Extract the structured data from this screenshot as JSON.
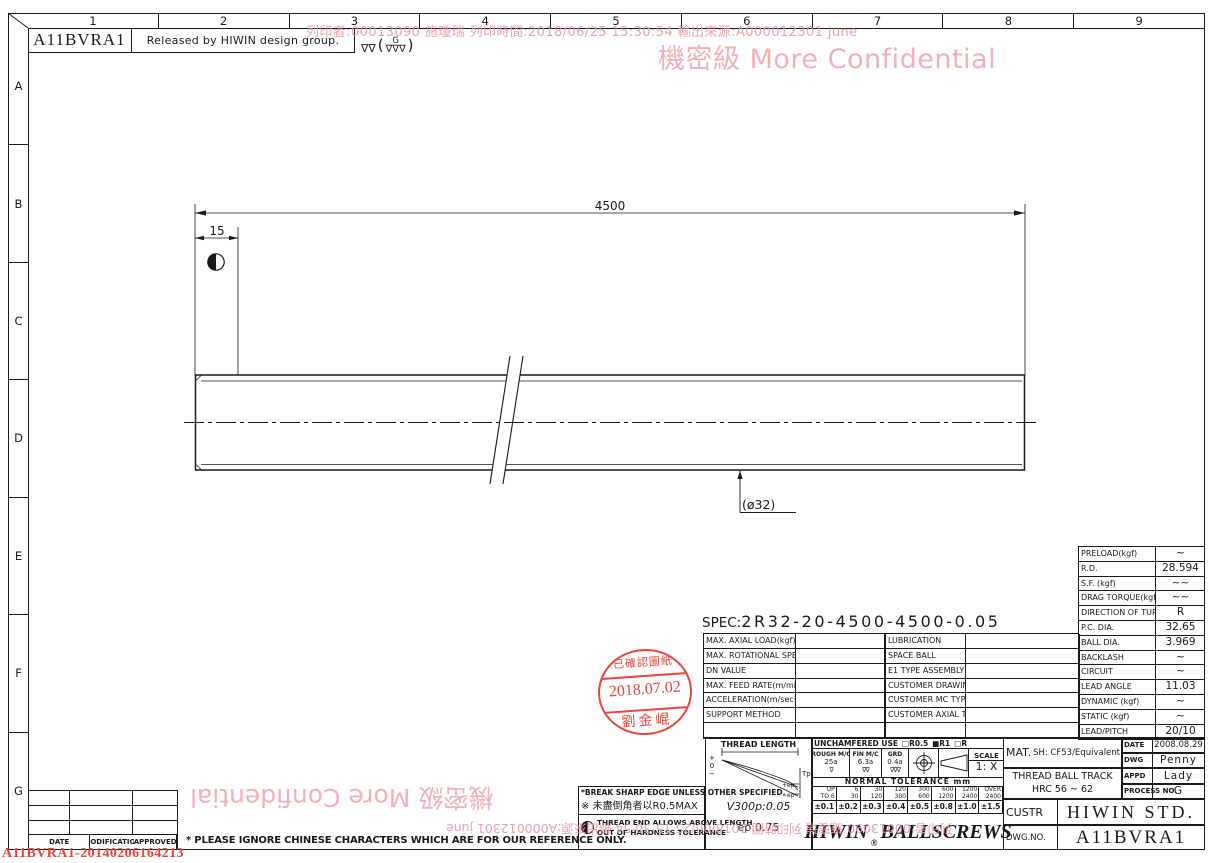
{
  "colors": {
    "line": "#1a1a1a",
    "watermark_pink": "#f3b1b6",
    "watermark_red": "#ec9aa3",
    "stamp_red": "#e5392f",
    "doc_id_red": "#e8443b"
  },
  "border": {
    "cols": [
      "1",
      "2",
      "3",
      "4",
      "5",
      "6",
      "7",
      "8",
      "9"
    ],
    "rows": [
      "A",
      "B",
      "C",
      "D",
      "E",
      "F",
      "G"
    ]
  },
  "header": {
    "code": "A11BVRA1",
    "released": "Released by HIWIN design group.",
    "finish_prefix": "∇∇",
    "finish_open": "(",
    "finish_grade": "G",
    "finish_marks": "∇∇∇",
    "finish_close": ")"
  },
  "watermark": {
    "print_line": "列印者:00013090 施瓊瑞 列印時間:2018/06/25 15:30:54 輸出來源:A000012301 june",
    "confidential": "機密級 More Confidential",
    "doc_id": "A11BVRA1-20140206164213"
  },
  "drawing": {
    "dim_total": "4500",
    "dim_left": "15",
    "diameter": "(ø32)"
  },
  "spec": {
    "label": "SPEC:",
    "value": "2R32-20-4500-4500-0.05"
  },
  "spec_table": {
    "left_rows": [
      {
        "label": "MAX. AXIAL LOAD(kgf)",
        "value": ""
      },
      {
        "label": "MAX. ROTATIONAL SPEED(rpm)",
        "value": ""
      },
      {
        "label": "DN VALUE",
        "value": ""
      },
      {
        "label": "MAX. FEED RATE(m/min)",
        "value": ""
      },
      {
        "label": "ACCELERATION(m/sec²)",
        "value": ""
      },
      {
        "label": "SUPPORT METHOD",
        "value": ""
      },
      {
        "label": "",
        "value": ""
      }
    ],
    "right_rows": [
      {
        "label": "LUBRICATION",
        "value": ""
      },
      {
        "label": "SPACE BALL",
        "value": ""
      },
      {
        "label": "E1 TYPE ASSEMBLY METHOD",
        "value": ""
      },
      {
        "label": "CUSTOMER DRAWING NO.",
        "value": ""
      },
      {
        "label": "CUSTOMER MC TYPE",
        "value": ""
      },
      {
        "label": "CUSTOMER AXIAL TYPE",
        "value": ""
      },
      {
        "label": "",
        "value": ""
      }
    ]
  },
  "data_table": {
    "rows": [
      {
        "label": "PRELOAD(kgf)",
        "value": "~"
      },
      {
        "label": "R.D.",
        "value": "28.594"
      },
      {
        "label": "S.F. (kgf)",
        "value": "∼∼"
      },
      {
        "label": "DRAG TORQUE(kgf-cm)",
        "value": "∼∼"
      },
      {
        "label": "DIRECTION OF TURN",
        "value": "R"
      },
      {
        "label": "P.C. DIA.",
        "value": "32.65"
      },
      {
        "label": "BALL DIA.",
        "value": "3.969"
      },
      {
        "label": "BACKLASH",
        "value": "~"
      },
      {
        "label": "CIRCUIT",
        "value": "~"
      },
      {
        "label": "LEAD ANGLE",
        "value": "11.03"
      },
      {
        "label": "DYNAMIC (kgf)",
        "value": "~"
      },
      {
        "label": "STATIC (kgf)",
        "value": "~"
      },
      {
        "label": "LEAD/PITCH",
        "value": "20/10"
      }
    ]
  },
  "stamp": {
    "line1": "已確認圖紙",
    "line2": "2018.07.02",
    "line3": "劉金崐"
  },
  "notes": {
    "note1": "*BREAK SHARP EDGE UNLESS OTHER SPECIFIED.",
    "note2": "※ 未盡倒角者以R0.5MAX",
    "note3a": "THREAD END ALLOWS ABOVE LENGTH",
    "note3b": "OUT OF HARDNESS TOLERANCE"
  },
  "thread_box": {
    "title": "THREAD LENGTH",
    "plus": "+",
    "zero": "0",
    "minus": "−",
    "tp": "Tp",
    "ep_plus": "+ep",
    "ep_minus": "−ep",
    "v300": "V300p:0.05",
    "ep": "ep:0.75"
  },
  "tolerance": {
    "unchamfered": "UNCHAMFERED USE",
    "opt1": "□R0.5",
    "opt2": "■R1",
    "opt3": "□R",
    "rough_label": "ROUGH M/C",
    "rough_value": "25a",
    "rough_sym": "∇",
    "fin_label": "FIN M/C",
    "fin_value": "6.3a",
    "fin_sym": "∇∇",
    "grd_label": "GRD",
    "grd_value": "0.4a",
    "grd_sym": "∇∇∇",
    "scale_label": "SCALE",
    "scale_value": "1: X",
    "normal": "NORMAL TOLERANCE mm",
    "cols": [
      {
        "top": "UP",
        "bottom": "TO 6",
        "value": "±0.1"
      },
      {
        "top": "6",
        "bottom": "30",
        "value": "±0.2"
      },
      {
        "top": "30",
        "bottom": "120",
        "value": "±0.3"
      },
      {
        "top": "120",
        "bottom": "300",
        "value": "±0.4"
      },
      {
        "top": "300",
        "bottom": "600",
        "value": "±0.5"
      },
      {
        "top": "600",
        "bottom": "1200",
        "value": "±0.8"
      },
      {
        "top": "1200",
        "bottom": "2400",
        "value": "±1.0"
      },
      {
        "top": "OVER",
        "bottom": "2400",
        "value": "±1.5"
      }
    ]
  },
  "title_block": {
    "logo_brand": "HIWIN",
    "logo_reg": "®",
    "logo_product": "BALLSCREWS",
    "mat_label": "MAT.",
    "mat_value": "SH: CF53/Equivalent",
    "thread_track1": "THREAD BALL TRACK",
    "thread_track2": "HRC 56 ~ 62",
    "date_label": "DATE",
    "date_value": "2008.08.29",
    "dwg_label": "DWG",
    "dwg_value": "Penny",
    "appd_label": "APPD",
    "appd_value": "Lady",
    "process_label": "PROCESS NO.",
    "process_value": "G",
    "custr_label": "CUSTR",
    "custr_value": "HIWIN STD.",
    "dwgno_label": "DWG.NO.",
    "dwgno_value": "A11BVRA1"
  },
  "revision": {
    "headers": [
      "DATE",
      "MODIFICATION",
      "APPROVED"
    ]
  },
  "footer": {
    "note": "* PLEASE IGNORE CHINESE CHARACTERS WHICH ARE FOR OUR REFERENCE ONLY."
  }
}
